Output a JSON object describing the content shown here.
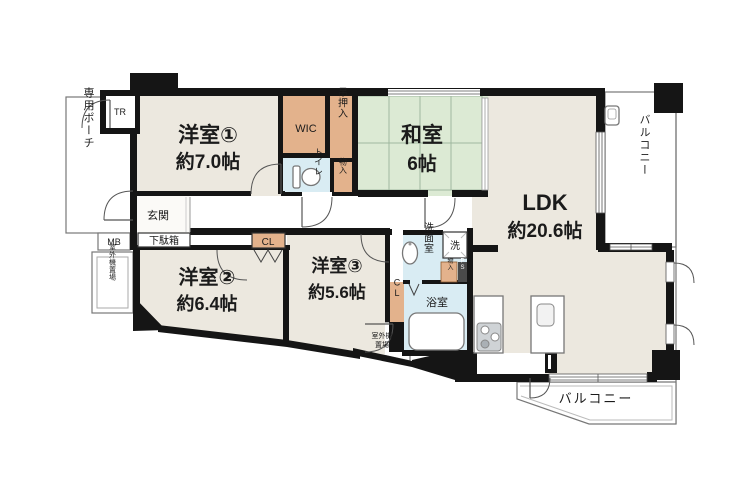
{
  "rooms": {
    "west1": {
      "name": "洋室①",
      "size": "約7.0帖"
    },
    "west2": {
      "name": "洋室②",
      "size": "約6.4帖"
    },
    "west3": {
      "name": "洋室③",
      "size": "約5.6帖"
    },
    "washitsu": {
      "name": "和室",
      "size": "6帖"
    },
    "ldk": {
      "name": "LDK",
      "size": "約20.6帖"
    },
    "bath": {
      "name": "浴室"
    },
    "washroom": {
      "name": "洗面室"
    },
    "toilet": {
      "name": "トイレ"
    },
    "entrance": {
      "name": "玄関"
    }
  },
  "storage": {
    "wic": "WIC",
    "hanging_closet": "吊押入",
    "closet1": "CL",
    "closet2": "CL",
    "storage1": "物入",
    "storage2": "物入",
    "shoe_cabinet": "下駄箱",
    "trunk_room": "TR"
  },
  "exterior": {
    "balcony_right": "バルコニー",
    "balcony_bottom": "バルコニー",
    "private_porch": "専用ポーチ",
    "meter_box": "MB",
    "pipe_space": "PS",
    "outdoor_unit_left": "室外機置場",
    "outdoor_unit_bottom_l1": "室外機",
    "outdoor_unit_bottom_l2": "置場",
    "washer": "洗"
  },
  "colors": {
    "floor_beige": "#ece8df",
    "tatami_green": "#dcead4",
    "closet_tan": "#e3b28c",
    "wet_blue": "#d9ecf3",
    "wall_black": "#151515"
  }
}
